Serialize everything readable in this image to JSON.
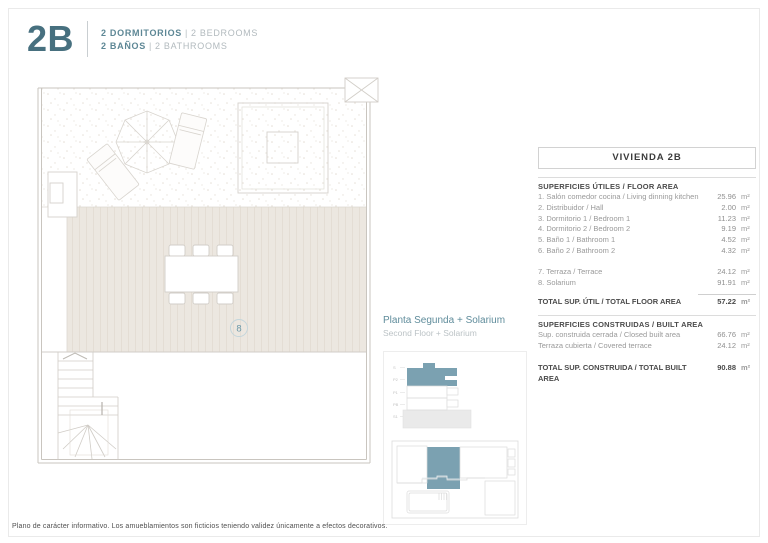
{
  "header": {
    "unit_code": "2B",
    "lines": [
      {
        "primary": "2 DORMITORIOS",
        "separator": "|",
        "secondary": "2 BEDROOMS"
      },
      {
        "primary": "2 BAÑOS",
        "separator": "|",
        "secondary": "2 BATHROOMS"
      }
    ]
  },
  "plan": {
    "room_number": "8"
  },
  "location": {
    "title_es": "Planta Segunda + Solarium",
    "title_en": "Second Floor + Solarium",
    "floor_labels": [
      "S",
      "P2",
      "P1",
      "PB",
      "S1"
    ]
  },
  "table": {
    "title": "VIVIENDA 2B",
    "unit": "m²",
    "useful": {
      "heading": "SUPERFICIES ÚTILES / FLOOR AREA",
      "rows": [
        {
          "label": "1. Salón comedor cocina / Living dinning kitchen",
          "value": "25.96"
        },
        {
          "label": "2. Distribuidor / Hall",
          "value": "2.00"
        },
        {
          "label": "3. Dormitorio 1 / Bedroom 1",
          "value": "11.23"
        },
        {
          "label": "4. Dormitorio 2 / Bedroom 2",
          "value": "9.19"
        },
        {
          "label": "5. Baño 1 / Bathroom 1",
          "value": "4.52"
        },
        {
          "label": "6. Baño 2 / Bathroom 2",
          "value": "4.32"
        },
        {
          "label": "7. Terraza / Terrace",
          "value": "24.12"
        },
        {
          "label": "8. Solarium",
          "value": "91.91"
        }
      ],
      "total_label": "TOTAL SUP. ÚTIL / TOTAL FLOOR AREA",
      "total_value": "57.22"
    },
    "built": {
      "heading": "SUPERFICIES CONSTRUIDAS / BUILT AREA",
      "rows": [
        {
          "label": "Sup. construida cerrada / Closed built area",
          "value": "66.76"
        },
        {
          "label": "Terraza cubierta / Covered terrace",
          "value": "24.12"
        }
      ],
      "total_label": "TOTAL SUP. CONSTRUIDA /  TOTAL BUILT AREA",
      "total_value": "90.88"
    }
  },
  "footer": {
    "disclaimer": "Plano de carácter informativo. Los amueblamientos son ficticios teniendo validez únicamente a efectos decorativos."
  },
  "colors": {
    "accent_teal": "#47707f",
    "diagram_fill": "#7ba1b1",
    "deck_beige": "#ece7e0",
    "line_gray": "#d6d2cc"
  }
}
